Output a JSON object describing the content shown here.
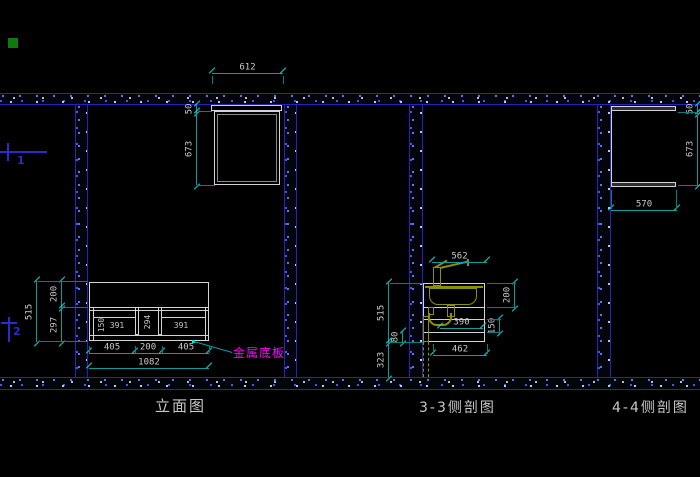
{
  "views": {
    "elevation": {
      "label": "立面图",
      "annotation": "金属底板",
      "dims": {
        "top_width": "612",
        "top_offset": "50",
        "upper_height": "673",
        "left_total": "515",
        "left_upper": "200",
        "left_lower": "297",
        "shelf_height": "150",
        "bay_left_width": "391",
        "middle_height": "294",
        "bay_right_width": "391",
        "col_left": "405",
        "col_middle": "200",
        "col_right": "405",
        "total_width": "1082"
      }
    },
    "section_3_3": {
      "label": "3-3侧剖图",
      "dims": {
        "counter_width": "562",
        "cabinet_height": "515",
        "base_height": "80",
        "below_height": "323",
        "sink_height": "200",
        "drawer_height": "150",
        "drawer_width": "390",
        "bottom_width": "462"
      }
    },
    "section_4_4": {
      "label": "4-4侧剖图",
      "dims": {
        "top_offset": "50",
        "height": "673",
        "depth": "570"
      }
    }
  },
  "markers": {
    "m1": "1",
    "m2": "2"
  },
  "colors": {
    "background": "#000000",
    "wall_edge": "#2424bd",
    "wall_speckle": "#5b7dff",
    "drawing_line": "#d4d4d4",
    "dimension_line": "#0e9b9b",
    "dimension_tick": "#00e8e8",
    "dimension_text": "#c9c9c9",
    "fixture_line": "#8f8f00",
    "annotation_text": "#ff00ff",
    "marker_blue": "#2a2ad0",
    "green_square": "#0e7a0e"
  }
}
